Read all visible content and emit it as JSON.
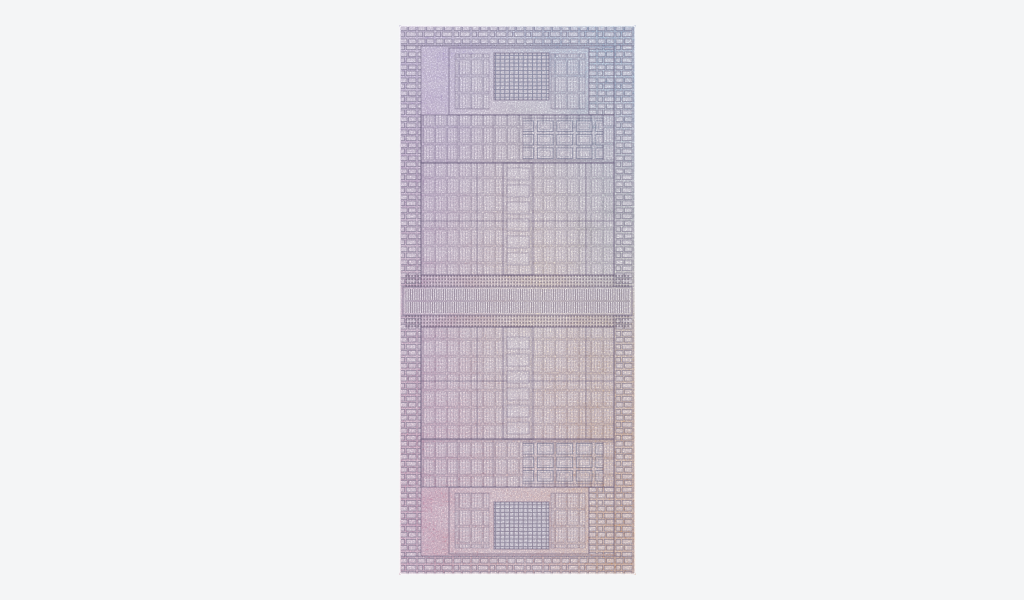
{
  "figure": {
    "description": "Iridescent silicon die shot of a dual-die processor: two mirrored dies joined by a central die-to-die interconnect band, photographed with a rainbow sheen on a plain light-gray background",
    "background_color": "#f4f5f6",
    "die": {
      "border_color": "#ffffff",
      "palette": {
        "top": "#b9c4e4",
        "top_left": "#c5b2e4",
        "top_right": "#74b4da",
        "left_upper": "#a98ccd",
        "right_upper": "#8fb8c8",
        "center_left": "#cfa0b8",
        "center_warm": "#f0dcae",
        "right_mid": "#b4c4a2",
        "right_lower_gold": "#cdaa68",
        "bottom_left": "#c9719b",
        "bottom_center": "#dda49d",
        "bottom_right": "#d9924b",
        "line_dark": "#43395a",
        "grid_dark": "#4d5878"
      },
      "regions": [
        "io-edge-strip",
        "io-left-column",
        "io-right-column",
        "media-engine-block",
        "cache-grid",
        "core-array-band",
        "block-grid",
        "gpu-array-region",
        "gpu-center-column",
        "dense-logic-band",
        "interconnect-band",
        "mirrored-lower-die"
      ]
    }
  }
}
